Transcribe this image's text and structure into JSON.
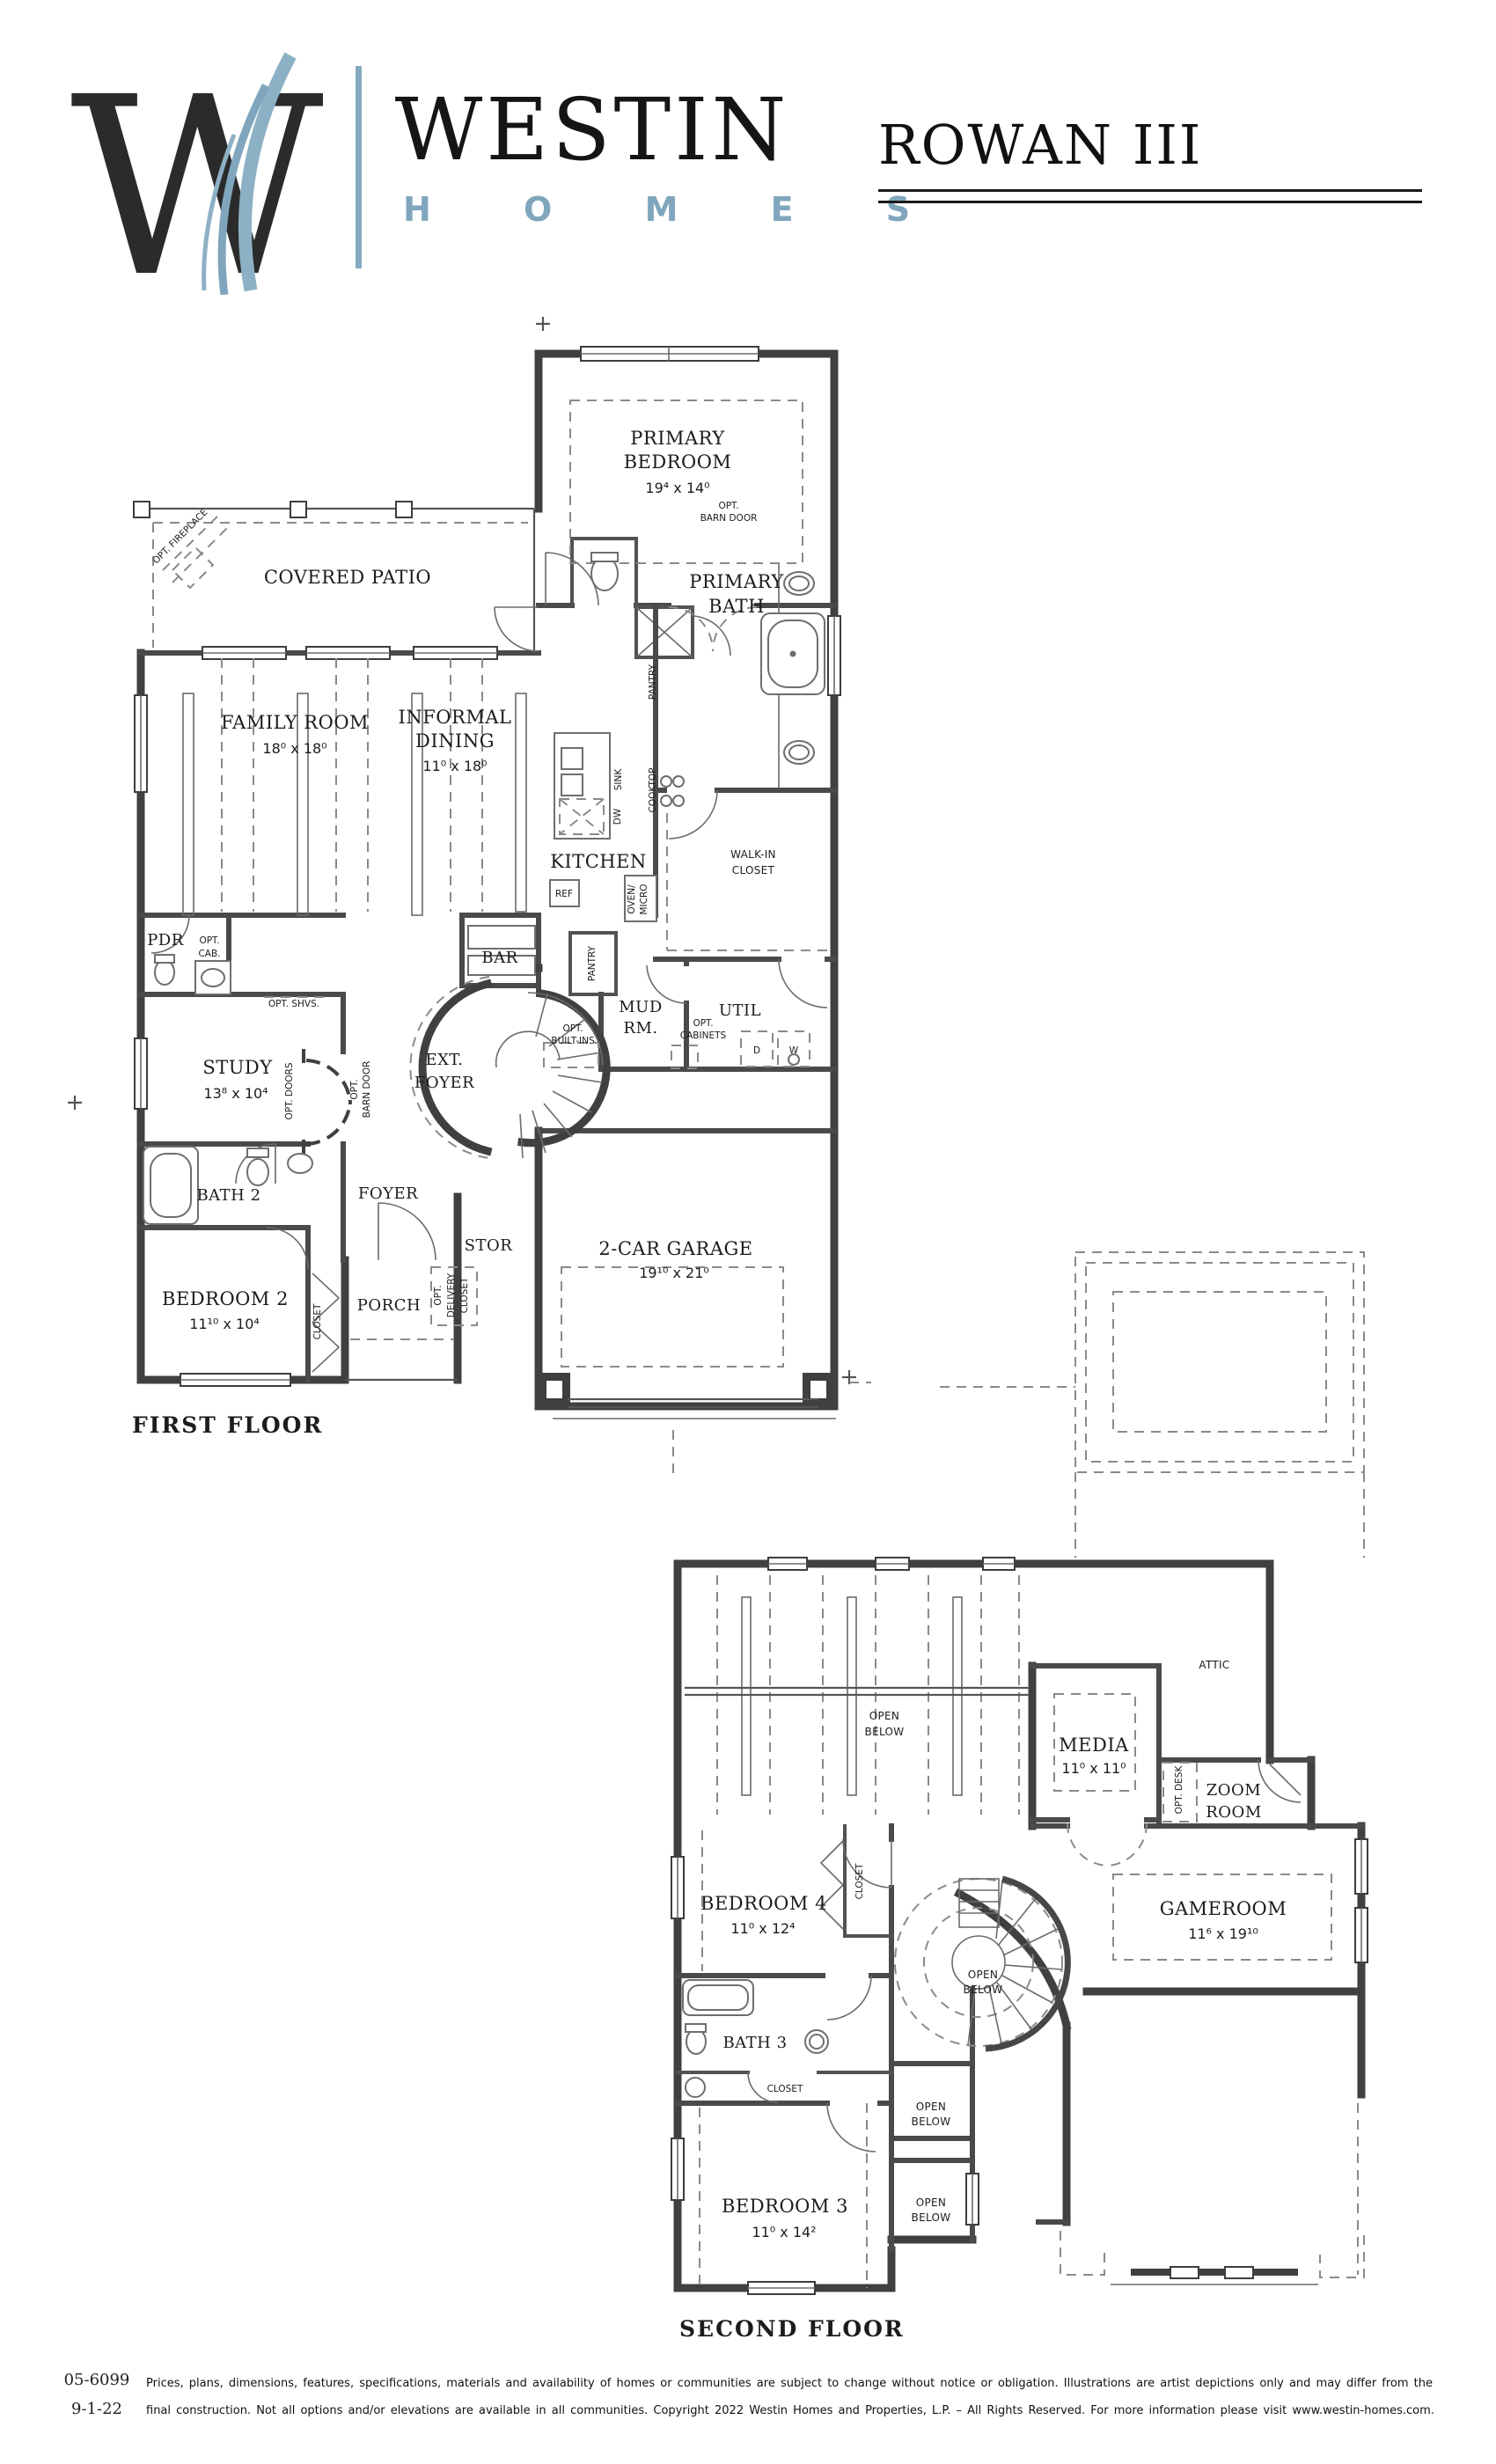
{
  "header": {
    "logo_letter": "W",
    "brand": "WESTIN",
    "brand_sub": "H O M E S",
    "plan_title": "ROWAN III"
  },
  "colors": {
    "accent": "#7fa6bc",
    "ink": "#1c1c1c",
    "wall": "#404040"
  },
  "ff": {
    "floor_label": "FIRST FLOOR",
    "primary_bedroom_l1": "PRIMARY",
    "primary_bedroom_l2": "BEDROOM",
    "primary_bedroom_dims": "19⁴ x 14⁰",
    "opt_barn_l1": "OPT.",
    "opt_barn_l2": "BARN DOOR",
    "covered_patio": "COVERED PATIO",
    "opt_fireplace": "OPT. FIREPLACE",
    "family_room": "FAMILY ROOM",
    "family_room_dims": "18⁰ x 18⁰",
    "informal_l1": "INFORMAL",
    "informal_l2": "DINING",
    "informal_dims": "11⁰ x 18⁰",
    "primary_bath_l1": "PRIMARY",
    "primary_bath_l2": "BATH",
    "pantry": "PANTRY",
    "sink": "SINK",
    "dw": "DW",
    "cooktop": "COOKTOP",
    "kitchen": "KITCHEN",
    "ref": "REF",
    "oven_l1": "OVEN/",
    "oven_l2": "MICRO",
    "walkin_l1": "WALK-IN",
    "walkin_l2": "CLOSET",
    "pdr": "PDR",
    "opt_cab_l1": "OPT.",
    "opt_cab_l2": "CAB.",
    "opt_shvs": "OPT. SHVS.",
    "bar": "BAR",
    "pantry2": "PANTRY",
    "mud_l1": "MUD",
    "mud_l2": "RM.",
    "util": "UTIL",
    "opt_cabinets_l1": "OPT.",
    "opt_cabinets_l2": "CABINETS",
    "d": "D",
    "w": "W",
    "opt_builtins_l1": "OPT.",
    "opt_builtins_l2": "BUILT-INS",
    "ext_foyer_l1": "EXT.",
    "ext_foyer_l2": "FOYER",
    "study": "STUDY",
    "study_dims": "13⁸ x 10⁴",
    "opt_doors": "OPT. DOORS",
    "opt_barn2_l1": "OPT.",
    "opt_barn2_l2": "BARN DOOR",
    "bath2": "BATH 2",
    "foyer": "FOYER",
    "stor": "STOR",
    "bedroom2": "BEDROOM 2",
    "bedroom2_dims": "11¹⁰ x 10⁴",
    "closet": "CLOSET",
    "porch": "PORCH",
    "opt_dlv_l1": "OPT.",
    "opt_dlv_l2": "DELIVERY",
    "opt_dlv_l3": "CLOSET",
    "garage": "2-CAR GARAGE",
    "garage_dims": "19¹⁰ x 21⁰"
  },
  "sf": {
    "floor_label": "SECOND FLOOR",
    "open_l1": "OPEN",
    "open_l2": "BELOW",
    "media": "MEDIA",
    "media_dims": "11⁰ x 11⁰",
    "attic": "ATTIC",
    "opt_desk": "OPT. DESK",
    "zoom_l1": "ZOOM",
    "zoom_l2": "ROOM",
    "bedroom4": "BEDROOM 4",
    "bedroom4_dims": "11⁰ x 12⁴",
    "closet": "CLOSET",
    "gameroom": "GAMEROOM",
    "gameroom_dims": "11⁶ x 19¹⁰",
    "bath3": "BATH 3",
    "bedroom3": "BEDROOM 3",
    "bedroom3_dims": "11⁰ x 14²"
  },
  "footer": {
    "sheet_no": "05-6099",
    "date": "9-1-22",
    "line1": "Prices, plans, dimensions, features, specifications, materials and availability of homes or communities are subject to change without notice or obligation.  Illustrations are artist depictions only and may differ from the",
    "line2": "final construction.  Not all options and/or elevations are available in all communities.  Copyright 2022 Westin Homes and Properties, L.P. – All Rights Reserved.  For more information please visit www.westin-homes.com."
  }
}
